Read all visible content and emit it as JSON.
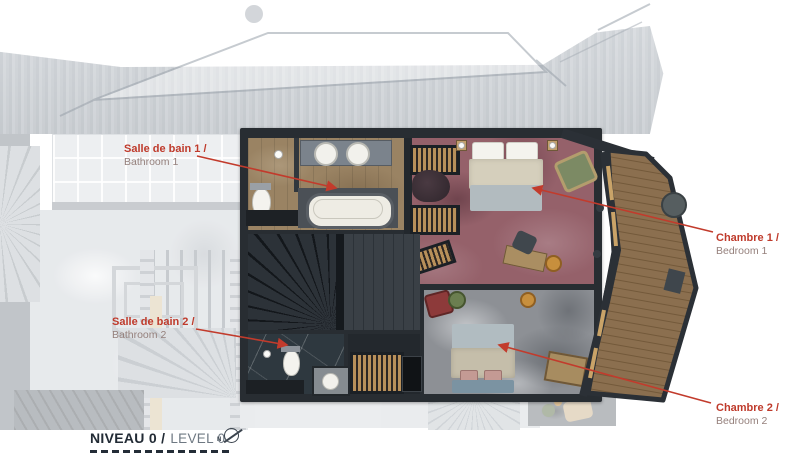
{
  "annotations": [
    {
      "id": "bathroom-1",
      "fr": "Salle de bain 1 /",
      "en": "Bathroom 1"
    },
    {
      "id": "bathroom-2",
      "fr": "Salle de bain 2 /",
      "en": "Bathroom 2"
    },
    {
      "id": "bedroom-1",
      "fr": "Chambre 1 /",
      "en": "Bedroom 1"
    },
    {
      "id": "bedroom-2",
      "fr": "Chambre 2 /",
      "en": "Bedroom 2"
    }
  ],
  "level_title": {
    "fr": "NIVEAU 0 /",
    "en": "LEVEL 0"
  },
  "north_indicator": {
    "letter": "N"
  },
  "colors": {
    "annotation_red": "#bf3a2b",
    "annotation_sub_gray": "#95807c",
    "title_dark": "#222b35",
    "title_gray": "#6e7882",
    "wall_dark": "#282d32",
    "bedroom1_carpet": "#95616a",
    "bedroom2_carpet": "#8d9095",
    "bathroom1_floor": "#9a8363",
    "deck_wood": "#8b6f4f"
  }
}
